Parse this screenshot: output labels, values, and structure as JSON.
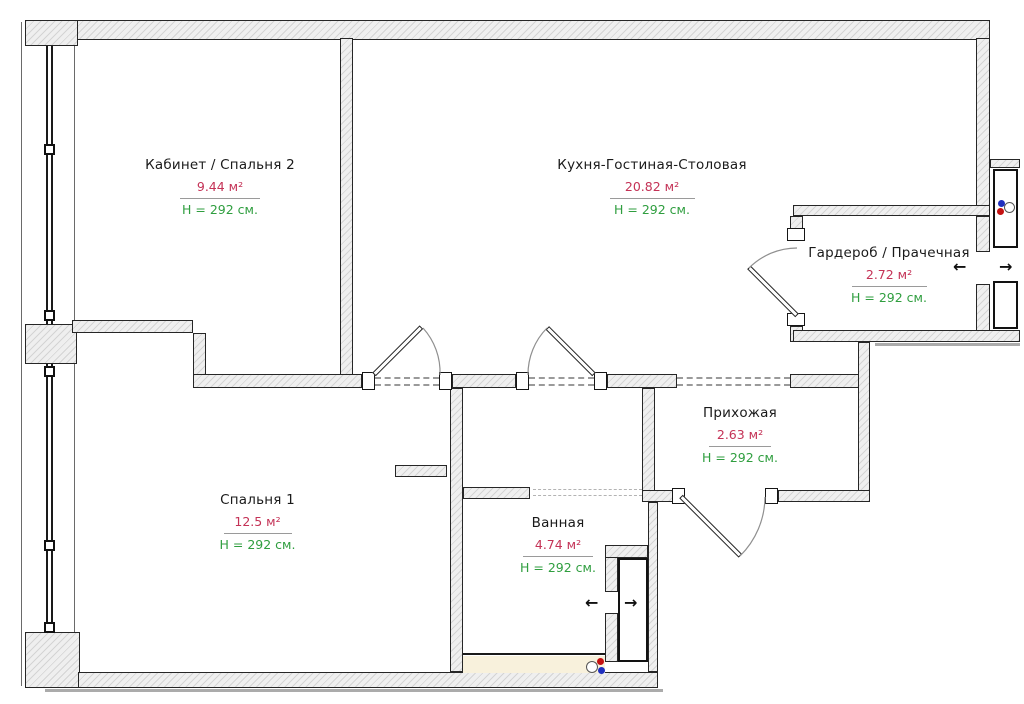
{
  "rooms": [
    {
      "id": "office",
      "name": "Кабинет / Спальня 2",
      "area": "9.44 м²",
      "height": "H = 292 см."
    },
    {
      "id": "kitchen",
      "name": "Кухня-Гостиная-Столовая",
      "area": "20.82 м²",
      "height": "H = 292 см."
    },
    {
      "id": "wardrobe",
      "name": "Гардероб / Прачечная",
      "area": "2.72 м²",
      "height": "H = 292 см."
    },
    {
      "id": "hallway",
      "name": "Прихожая",
      "area": "2.63 м²",
      "height": "H = 292 см."
    },
    {
      "id": "bedroom1",
      "name": "Спальня 1",
      "area": "12.5 м²",
      "height": "H = 292 см."
    },
    {
      "id": "bathroom",
      "name": "Ванная",
      "area": "4.74 м²",
      "height": "H = 292 см."
    }
  ],
  "symbols": {
    "arrow_left": "←",
    "arrow_right": "→"
  },
  "colors": {
    "room_text": "#1A1A1A",
    "area_text": "#C43256",
    "height_text": "#2F9E3F",
    "wall_fill": "#EFEFEF",
    "hot_water_dot": "#C41111",
    "cold_water_dot": "#1F2FBF",
    "bath_floor_strip": "#F8F1DC"
  }
}
